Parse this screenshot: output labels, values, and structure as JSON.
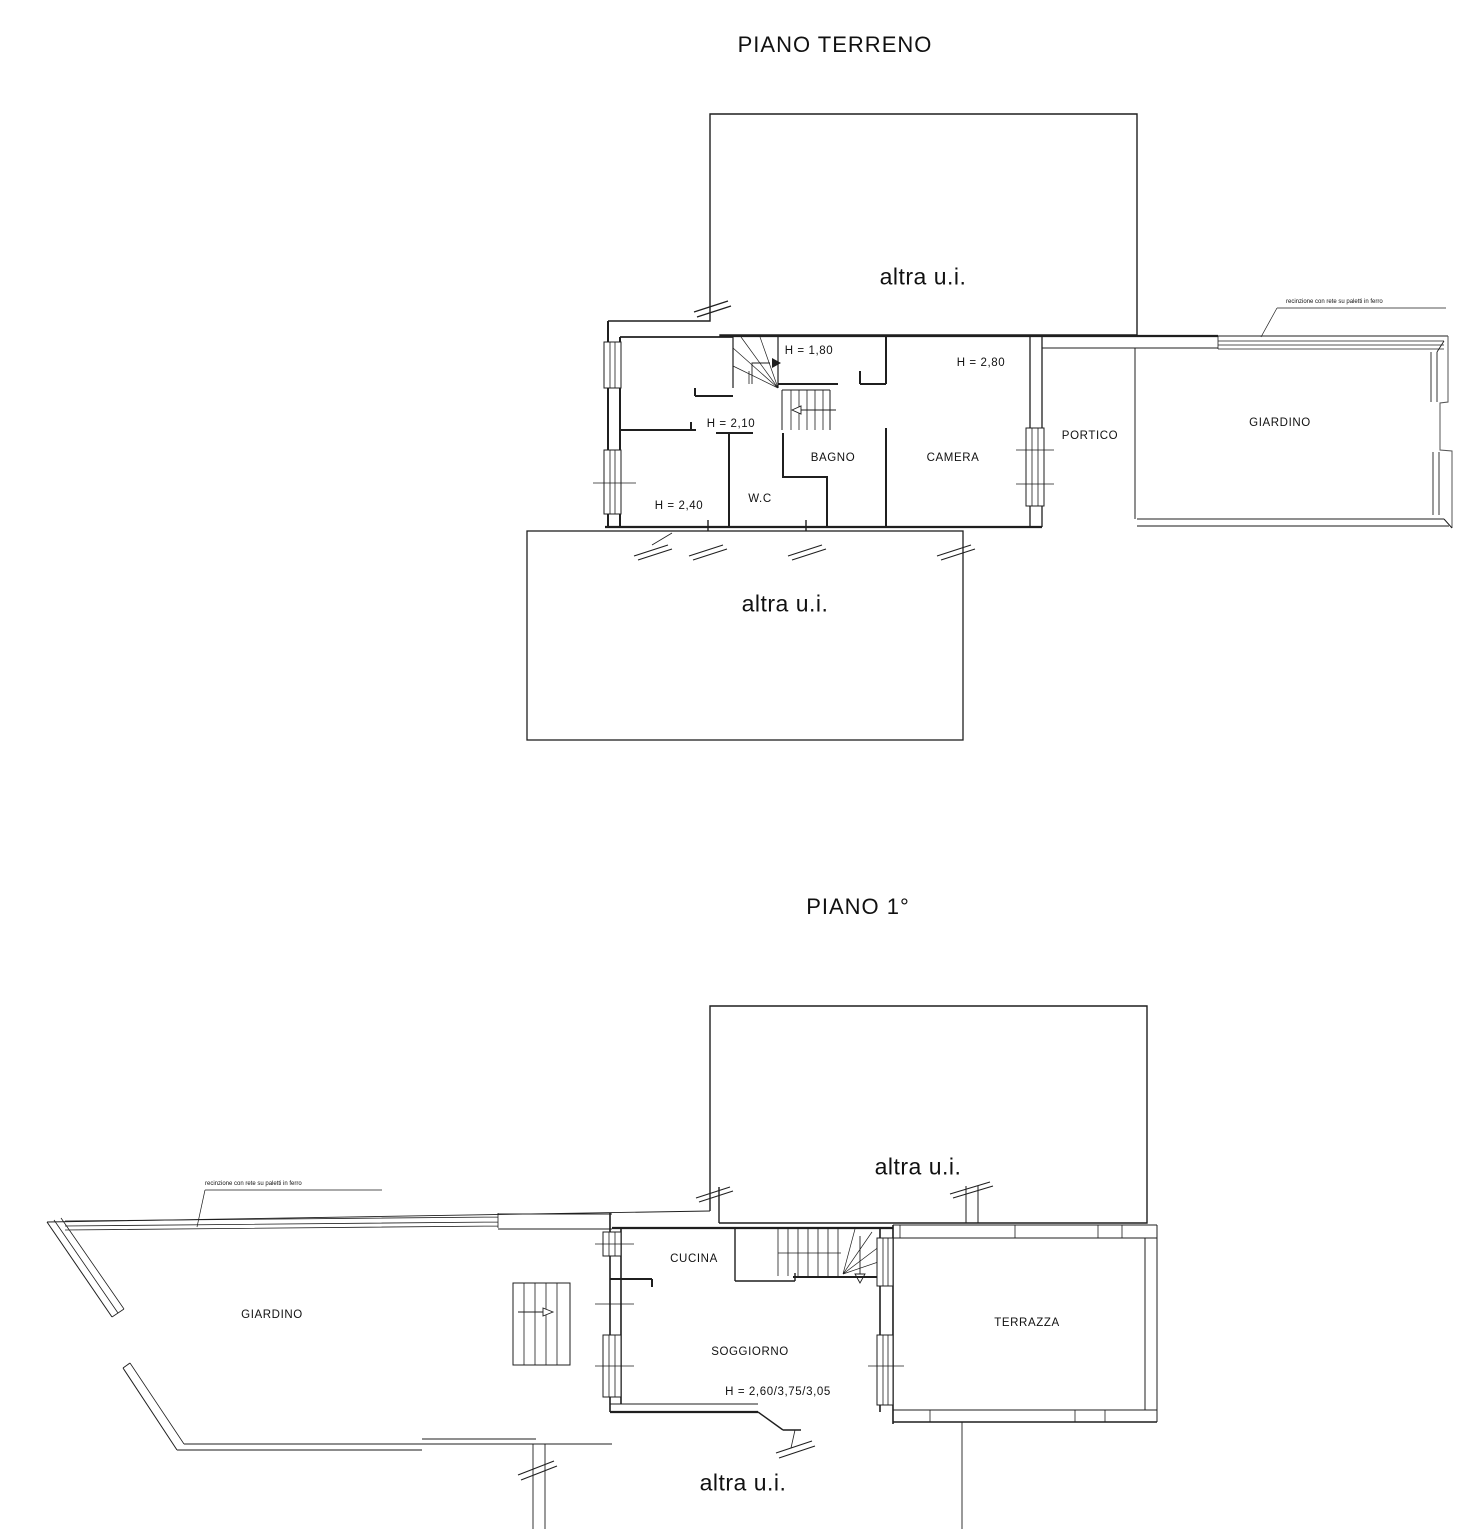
{
  "ground_floor": {
    "title": "PIANO TERRENO",
    "unit_other_top": "altra u.i.",
    "unit_other_bottom": "altra u.i.",
    "rooms": {
      "bagno": "BAGNO",
      "wc": "W.C",
      "camera": "CAMERA",
      "portico": "PORTICO",
      "giardino": "GIARDINO"
    },
    "heights": {
      "h_stair": "H = 1,80",
      "h_camera": "H = 2,80",
      "h_mid": "H = 2,10",
      "h_left": "H = 2,40"
    },
    "fence_note": "recinzione con rete su paletti in ferro"
  },
  "first_floor": {
    "title": "PIANO 1°",
    "unit_other_top": "altra u.i.",
    "unit_other_bottom": "altra u.i.",
    "rooms": {
      "cucina": "CUCINA",
      "soggiorno": "SOGGIORNO",
      "terrazza": "TERRAZZA",
      "giardino": "GIARDINO"
    },
    "heights": {
      "soggiorno": "H = 2,60/3,75/3,05"
    },
    "fence_note": "recinzione con rete su paletti in ferro"
  },
  "colors": {
    "line": "#1f1f1f",
    "gray_line": "#666666",
    "background": "#ffffff"
  }
}
